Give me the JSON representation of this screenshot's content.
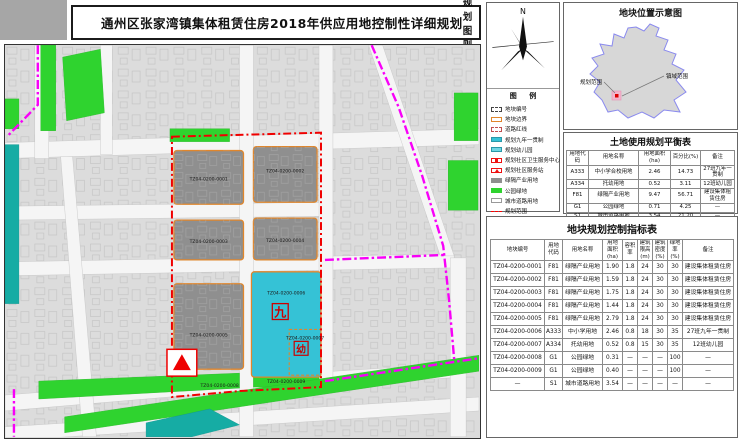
{
  "title_bar": {
    "title": "通州区张家湾镇集体租赁住房2018年供应用地控制性详细规划",
    "right_label": "规划图则"
  },
  "north": {
    "label": "N"
  },
  "legend": {
    "title": "图 例",
    "items": [
      {
        "label": "地块编号",
        "swatch": "parcel-code"
      },
      {
        "label": "地块边界",
        "swatch": "parcel-boundary"
      },
      {
        "label": "道路红线",
        "swatch": "road-redline"
      },
      {
        "label": "规划九年一贯制",
        "swatch": "school"
      },
      {
        "label": "规划幼儿园",
        "swatch": "kindergarten"
      },
      {
        "label": "规划社区卫生服务中心",
        "swatch": "health"
      },
      {
        "label": "规划社区服务站",
        "swatch": "service"
      },
      {
        "label": "绿隔产业用地",
        "swatch": "industry"
      },
      {
        "label": "公园绿地",
        "swatch": "park"
      },
      {
        "label": "城市道路用地",
        "swatch": "road"
      },
      {
        "label": "规划范围",
        "swatch": "scope-red"
      },
      {
        "label": "镇域范围",
        "swatch": "scope-town"
      }
    ]
  },
  "location_map": {
    "title": "地块位置示意图",
    "planning_scope_label": "规划范围",
    "town_scope_label": "镇域范围"
  },
  "balance_table": {
    "title": "土地使用规划平衡表",
    "headers": [
      "用地代码",
      "用地名称",
      "用地面积(ha)",
      "百分比(%)",
      "备注"
    ],
    "rows": [
      [
        "A333",
        "中小学合校用地",
        "2.46",
        "14.73",
        "27班九年一贯制"
      ],
      [
        "A334",
        "托幼用地",
        "0.52",
        "3.11",
        "12班幼儿园"
      ],
      [
        "F81",
        "绿隔产业用地",
        "9.47",
        "56.71",
        "建设集体租赁住房"
      ],
      [
        "G1",
        "公园绿地",
        "0.71",
        "4.25",
        "—"
      ],
      [
        "S1",
        "城市道路用地",
        "3.54",
        "21.20",
        "—"
      ]
    ],
    "total": [
      "地块规划范围",
      "16.70",
      "100.00",
      "—"
    ]
  },
  "indicator_table": {
    "title": "地块规划控制指标表",
    "headers": [
      "地块编号",
      "用地\n代码",
      "用地名称",
      "用地\n面积\n(ha)",
      "容积\n率",
      "建筑\n限高\n(m)",
      "建筑\n密度\n(%)",
      "绿地\n率\n(%)",
      "备注"
    ],
    "rows": [
      [
        "TZ04-0200-0001",
        "F81",
        "绿隔产业用地",
        "1.90",
        "1.8",
        "24",
        "30",
        "30",
        "建设集体租赁住房"
      ],
      [
        "TZ04-0200-0002",
        "F81",
        "绿隔产业用地",
        "1.59",
        "1.8",
        "24",
        "30",
        "30",
        "建设集体租赁住房"
      ],
      [
        "TZ04-0200-0003",
        "F81",
        "绿隔产业用地",
        "1.75",
        "1.8",
        "24",
        "30",
        "30",
        "建设集体租赁住房"
      ],
      [
        "TZ04-0200-0004",
        "F81",
        "绿隔产业用地",
        "1.44",
        "1.8",
        "24",
        "30",
        "30",
        "建设集体租赁住房"
      ],
      [
        "TZ04-0200-0005",
        "F81",
        "绿隔产业用地",
        "2.79",
        "1.8",
        "24",
        "30",
        "30",
        "建设集体租赁住房"
      ],
      [
        "TZ04-0200-0006",
        "A333",
        "中小学用地",
        "2.46",
        "0.8",
        "18",
        "30",
        "35",
        "27班九年一贯制"
      ],
      [
        "TZ04-0200-0007",
        "A334",
        "托幼用地",
        "0.52",
        "0.8",
        "15",
        "30",
        "35",
        "12班幼儿园"
      ],
      [
        "TZ04-0200-0008",
        "G1",
        "公园绿地",
        "0.31",
        "—",
        "—",
        "—",
        "100",
        "—"
      ],
      [
        "TZ04-0200-0009",
        "G1",
        "公园绿地",
        "0.40",
        "—",
        "—",
        "—",
        "100",
        "—"
      ],
      [
        "—",
        "S1",
        "城市道路用地",
        "3.54",
        "—",
        "—",
        "—",
        "—",
        "—"
      ]
    ]
  },
  "map": {
    "parcels": [
      {
        "code": "TZ04-0200-0001"
      },
      {
        "code": "TZ04-0200-0002"
      },
      {
        "code": "TZ04-0200-0003"
      },
      {
        "code": "TZ04-0200-0004"
      },
      {
        "code": "TZ04-0200-0005"
      },
      {
        "code": "TZ04-0200-0006"
      },
      {
        "code": "TZ04-0200-0007"
      },
      {
        "code": "TZ04-0200-0008"
      },
      {
        "code": "TZ04-0200-0009"
      }
    ],
    "markers": {
      "school": "九",
      "kindergarten": "幼"
    }
  },
  "colors": {
    "industry_gray": "#8f8f8f",
    "school_cyan": "#35c2d6",
    "park_green": "#2fd32f",
    "teal": "#16aca4",
    "parcel_orange": "#e0862c",
    "scope_red": "#f00000",
    "town_magenta": "#f800f8"
  }
}
